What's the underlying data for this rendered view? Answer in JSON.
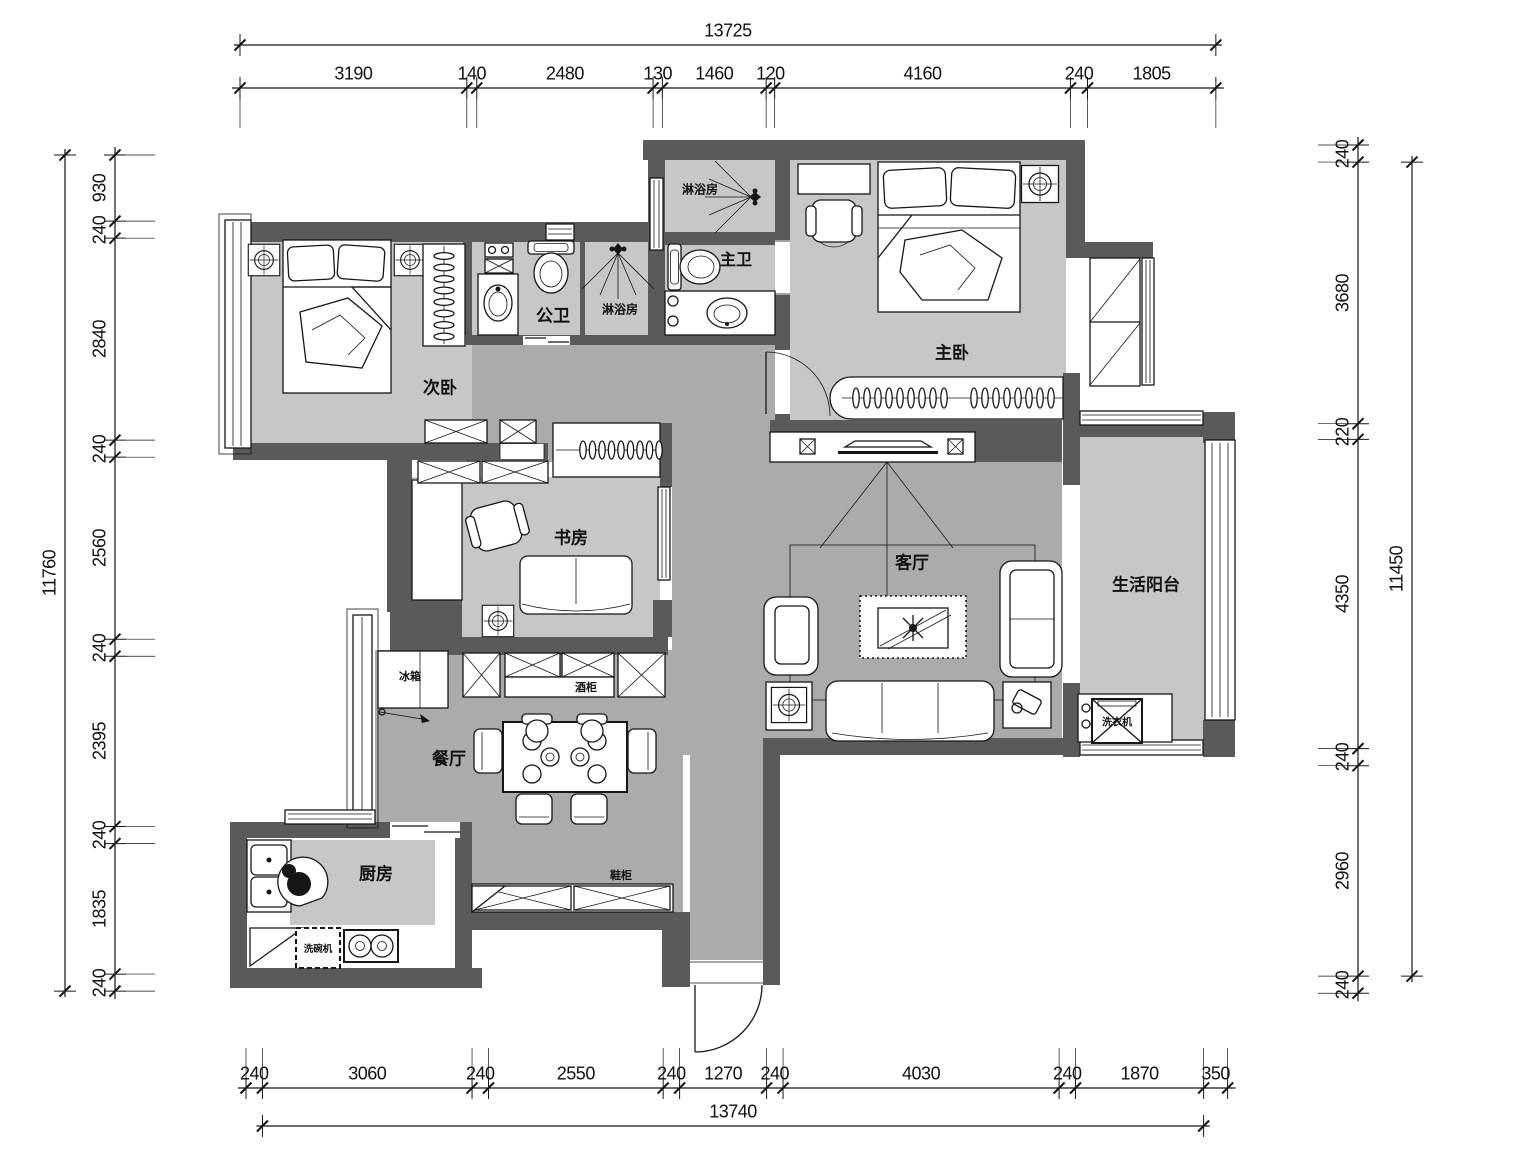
{
  "rooms": {
    "second_bedroom": "次卧",
    "master_bedroom": "主卧",
    "study": "书房",
    "living_room": "客厅",
    "dining_room": "餐厅",
    "kitchen": "厨房",
    "balcony": "生活阳台",
    "public_bath": "公卫",
    "master_bath": "主卫",
    "shower_top": "淋浴房",
    "shower_mid": "淋浴房"
  },
  "fixtures": {
    "fridge": "冰箱",
    "wine_cabinet": "酒柜",
    "shoe_cabinet": "鞋柜",
    "washing_machine": "洗衣机",
    "dishwasher": "洗碗机"
  },
  "dimensions": {
    "top": {
      "total": "13725",
      "segments": [
        "3190",
        "140",
        "2480",
        "130",
        "1460",
        "120",
        "4160",
        "240",
        "1805"
      ]
    },
    "bottom": {
      "total": "13740",
      "segments": [
        "240",
        "3060",
        "240",
        "2550",
        "240",
        "1270",
        "240",
        "4030",
        "240",
        "1870",
        "350"
      ]
    },
    "left": {
      "total": "11760",
      "segments": [
        "930",
        "240",
        "2840",
        "240",
        "2560",
        "240",
        "2395",
        "240",
        "1835",
        "240"
      ]
    },
    "right": {
      "total": "11450",
      "segments": [
        "240",
        "3680",
        "220",
        "4350",
        "240",
        "2960",
        "240"
      ]
    }
  },
  "colors": {
    "wall": "#5a5a5a",
    "room_floor": "#c7c7c7",
    "hall_floor": "#ababab",
    "line": "#161616"
  }
}
